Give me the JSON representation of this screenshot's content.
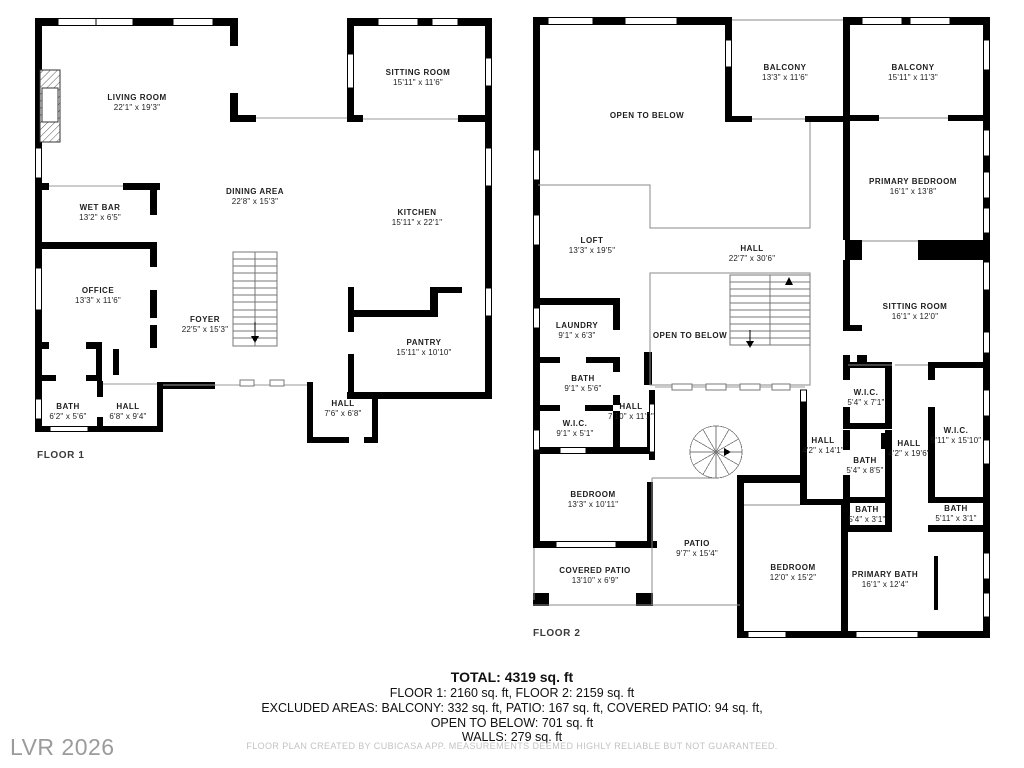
{
  "floor1": {
    "label": "FLOOR 1",
    "rooms": [
      {
        "name": "LIVING ROOM",
        "dims": "22'1\" x 19'3\""
      },
      {
        "name": "SITTING ROOM",
        "dims": "15'11\" x 11'6\""
      },
      {
        "name": "DINING AREA",
        "dims": "22'8\" x 15'3\""
      },
      {
        "name": "KITCHEN",
        "dims": "15'11\" x 22'1\""
      },
      {
        "name": "WET BAR",
        "dims": "13'2\" x 6'5\""
      },
      {
        "name": "OFFICE",
        "dims": "13'3\" x 11'6\""
      },
      {
        "name": "FOYER",
        "dims": "22'5\" x 15'3\""
      },
      {
        "name": "PANTRY",
        "dims": "15'11\" x 10'10\""
      },
      {
        "name": "BATH",
        "dims": "6'2\" x 5'6\""
      },
      {
        "name": "HALL",
        "dims": "6'8\" x 9'4\""
      },
      {
        "name": "HALL",
        "dims": "7'6\" x 6'8\""
      }
    ]
  },
  "floor2": {
    "label": "FLOOR 2",
    "rooms": [
      {
        "name": "OPEN TO BELOW",
        "dims": ""
      },
      {
        "name": "BALCONY",
        "dims": "13'3\" x 11'6\""
      },
      {
        "name": "BALCONY",
        "dims": "15'11\" x 11'3\""
      },
      {
        "name": "PRIMARY BEDROOM",
        "dims": "16'1\" x 13'8\""
      },
      {
        "name": "LOFT",
        "dims": "13'3\" x 19'5\""
      },
      {
        "name": "HALL",
        "dims": "22'7\" x 30'6\""
      },
      {
        "name": "OPEN TO BELOW",
        "dims": ""
      },
      {
        "name": "LAUNDRY",
        "dims": "9'1\" x 6'3\""
      },
      {
        "name": "SITTING ROOM",
        "dims": "16'1\" x 12'0\""
      },
      {
        "name": "BATH",
        "dims": "9'1\" x 5'6\""
      },
      {
        "name": "HALL",
        "dims": "7'10\" x 11'2\""
      },
      {
        "name": "W.I.C.",
        "dims": "9'1\" x 5'1\""
      },
      {
        "name": "BEDROOM",
        "dims": "13'3\" x 10'11\""
      },
      {
        "name": "W.I.C.",
        "dims": "5'4\" x 7'1\""
      },
      {
        "name": "HALL",
        "dims": "4'2\" x 14'1\""
      },
      {
        "name": "BATH",
        "dims": "5'4\" x 8'5\""
      },
      {
        "name": "HALL",
        "dims": "4'2\" x 19'6\""
      },
      {
        "name": "W.I.C.",
        "dims": "5'11\" x 15'10\""
      },
      {
        "name": "BATH",
        "dims": "5'4\" x 3'1\""
      },
      {
        "name": "BATH",
        "dims": "5'11\" x 3'1\""
      },
      {
        "name": "PATIO",
        "dims": "9'7\" x 15'4\""
      },
      {
        "name": "COVERED PATIO",
        "dims": "13'10\" x 6'9\""
      },
      {
        "name": "BEDROOM",
        "dims": "12'0\" x 15'2\""
      },
      {
        "name": "PRIMARY BATH",
        "dims": "16'1\" x 12'4\""
      }
    ]
  },
  "summary": {
    "total": "TOTAL: 4319 sq. ft",
    "floors": "FLOOR 1: 2160 sq. ft, FLOOR 2: 2159 sq. ft",
    "excluded1": "EXCLUDED AREAS: BALCONY: 332 sq. ft, PATIO: 167 sq. ft, COVERED PATIO: 94 sq. ft,",
    "excluded2": "OPEN TO BELOW: 701 sq. ft",
    "walls": "WALLS: 279 sq. ft"
  },
  "footer": {
    "disclaimer": "FLOOR PLAN CREATED BY CUBICASA APP. MEASUREMENTS DEEMED HIGHLY RELIABLE BUT NOT GUARANTEED.",
    "watermark": "LVR 2026"
  },
  "colors": {
    "wall": "#000000",
    "railing": "#8a8a8a",
    "text": "#1d1d1d",
    "muted": "#9b9b9b",
    "disclaimer": "#c3c3c3"
  }
}
